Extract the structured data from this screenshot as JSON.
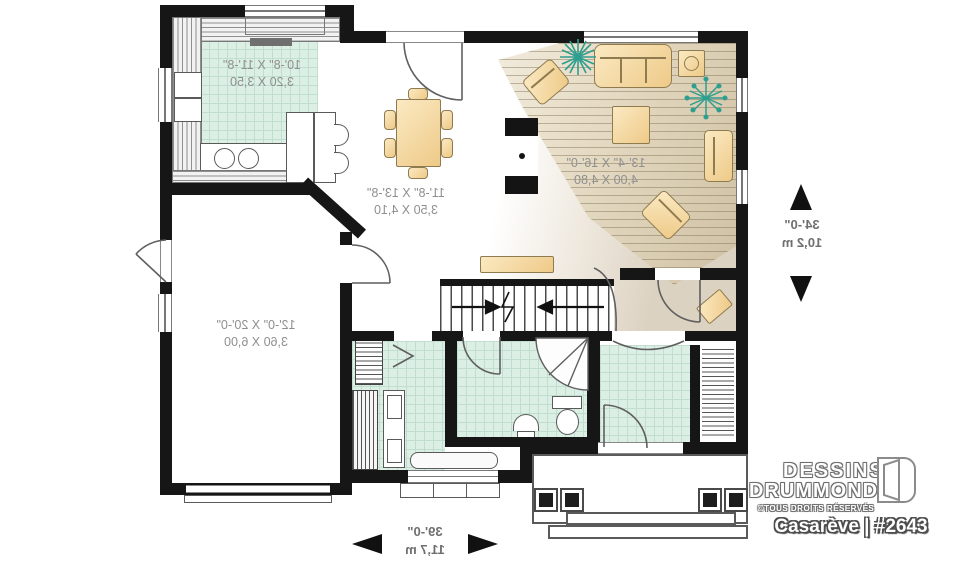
{
  "plan": {
    "rooms": [
      {
        "id": "kitchen",
        "imperial": "10'-8\" X 11'-8\"",
        "metric": "3,20 X 3,50"
      },
      {
        "id": "dining",
        "imperial": "11'-8\" X 13'-8\"",
        "metric": "3,50 X 4,10"
      },
      {
        "id": "living",
        "imperial": "13'-4\" X 16'-0\"",
        "metric": "4,00 X 4,80"
      },
      {
        "id": "garage",
        "imperial": "12'-0\" X 20'-0\"",
        "metric": "3,60 X 6,00"
      }
    ],
    "overall_dimensions": {
      "depth": {
        "imperial": "34'-0\"",
        "metric": "10,2 m"
      },
      "width": {
        "imperial": "39'-0\"",
        "metric": "11,7 m"
      }
    },
    "text_mirrored": true
  },
  "branding": {
    "brand_line1": "DESSINS",
    "brand_line2": "DRUMMOND",
    "rights": "©TOUS DROITS RÉSERVÉS",
    "model": "Casarève | #2643"
  },
  "icons": [
    "plant-icon",
    "door-logo-icon",
    "stair-arrow-icon",
    "dimension-arrow-icon"
  ],
  "colors": {
    "wall": "#161616",
    "tile_floor": "#dcefe4",
    "wood_floor": "#d9cdb3",
    "furniture": "#f3d494",
    "plant": "#2f9e8f",
    "dimension_text": "#8f8f8f"
  }
}
